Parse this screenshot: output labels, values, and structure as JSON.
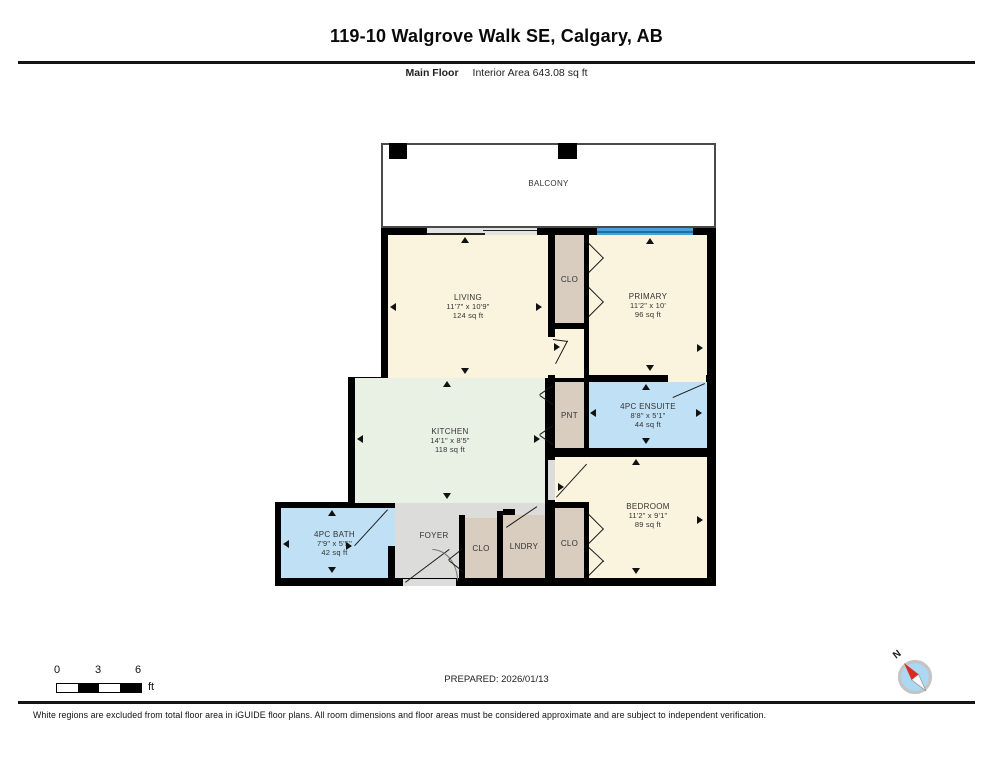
{
  "header": {
    "title": "119-10 Walgrove Walk SE, Calgary, AB",
    "floor_label": "Main Floor",
    "area_label": "Interior Area 643.08 sq ft"
  },
  "plan": {
    "balcony": {
      "name": "BALCONY"
    },
    "colors": {
      "cream": "#FAF3DE",
      "tan": "#D8CDBE",
      "mint": "#E9F1E4",
      "blue": "#BFE0F5",
      "gray": "#DCDCDA",
      "window": "#49A1D4",
      "windowline": "#1E6FA8",
      "slider": "#E3E3E1",
      "wall": "#000000"
    },
    "rooms": [
      {
        "key": "living",
        "name": "LIVING",
        "dims": "11'7\" x 10'9\"",
        "area": "124 sq ft",
        "rect": [
          388,
          235,
          160,
          143
        ],
        "fill": "cream"
      },
      {
        "key": "closet-primary",
        "name": "CLO",
        "rect": [
          555,
          235,
          29,
          88
        ],
        "fill": "tan"
      },
      {
        "key": "primary-entry",
        "name": "",
        "rect": [
          555,
          329,
          29,
          49
        ],
        "fill": "cream"
      },
      {
        "key": "primary",
        "name": "PRIMARY",
        "dims": "11'2\" x 10'",
        "area": "96 sq ft",
        "rect": [
          589,
          235,
          118,
          140
        ],
        "fill": "cream"
      },
      {
        "key": "kitchen",
        "name": "KITCHEN",
        "dims": "14'1\" x 8'5\"",
        "area": "118 sq ft",
        "rect": [
          355,
          378,
          190,
          125
        ],
        "fill": "mint"
      },
      {
        "key": "pantry",
        "name": "PNT",
        "rect": [
          555,
          382,
          29,
          66
        ],
        "fill": "tan"
      },
      {
        "key": "ensuite",
        "name": "4PC ENSUITE",
        "dims": "8'8\" x 5'1\"",
        "area": "44 sq ft",
        "rect": [
          589,
          382,
          118,
          66
        ],
        "fill": "blue"
      },
      {
        "key": "bedroom-hall",
        "name": "",
        "rect": [
          555,
          457,
          152,
          45
        ],
        "fill": "cream"
      },
      {
        "key": "bedroom",
        "name": "BEDROOM",
        "dims": "11'2\" x 9'1\"",
        "area": "89 sq ft",
        "rect": [
          589,
          502,
          118,
          76
        ],
        "fill": "cream",
        "label_rect": [
          589,
          460,
          118,
          110
        ]
      },
      {
        "key": "closet-bedroom",
        "name": "CLO",
        "rect": [
          555,
          508,
          29,
          70
        ],
        "fill": "tan"
      },
      {
        "key": "bath",
        "name": "4PC BATH",
        "dims": "7'9\" x 5'5\"",
        "area": "42 sq ft",
        "rect": [
          281,
          508,
          107,
          70
        ],
        "fill": "blue"
      },
      {
        "key": "foyer",
        "name": "FOYER",
        "rect": [
          395,
          503,
          150,
          75
        ],
        "fill": "gray",
        "label_rect": [
          395,
          508,
          78,
          55
        ]
      },
      {
        "key": "closet-foyer",
        "name": "CLO",
        "rect": [
          465,
          518,
          32,
          60
        ],
        "fill": "tan"
      },
      {
        "key": "laundry",
        "name": "LNDRY",
        "rect": [
          503,
          515,
          42,
          63
        ],
        "fill": "tan"
      }
    ]
  },
  "scale_bar": {
    "ticks": [
      "0",
      "3",
      "6"
    ],
    "unit": "ft"
  },
  "prepared": {
    "label": "PREPARED: 2026/01/13"
  },
  "compass": {
    "label": "N"
  },
  "disclaimer": "White regions are excluded from total floor area in iGUIDE floor plans. All room dimensions and floor areas must be considered approximate and are subject to independent verification."
}
